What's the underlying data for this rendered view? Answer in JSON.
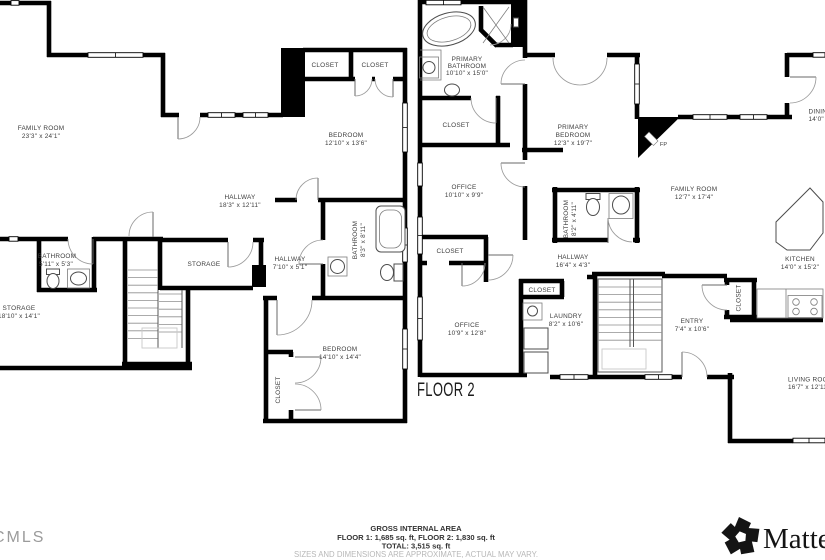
{
  "floor_label": "FLOOR 2",
  "area_summary": {
    "title": "GROSS INTERNAL AREA",
    "line1": "FLOOR 1: 1,685 sq. ft, FLOOR 2: 1,830 sq. ft",
    "line2": "TOTAL: 3,515 sq. ft",
    "disclaimer": "SIZES AND DIMENSIONS ARE APPROXIMATE, ACTUAL MAY VARY."
  },
  "branding": {
    "left_logo": "CMLS",
    "right_logo": "Matterport"
  },
  "colors": {
    "wall": "#000000",
    "label": "#3d3d3d",
    "muted": "#b8b8b8",
    "logo_gray": "#9b9b9b"
  },
  "rooms": [
    {
      "line1": "FAMILY ROOM",
      "dims": "23'3\" x 24'1\""
    },
    {
      "line1": "HALLWAY",
      "dims": "18'3\" x 12'11\""
    },
    {
      "line1": "BATHROOM",
      "dims": "5'11\" x 5'3\""
    },
    {
      "line1": "STORAGE",
      "dims": "18'10\" x 14'1\""
    },
    {
      "line1": "STORAGE"
    },
    {
      "line1": "CLOSET"
    },
    {
      "line1": "CLOSET"
    },
    {
      "line1": "BEDROOM",
      "dims": "12'10\" x 13'6\""
    },
    {
      "line1": "HALLWAY",
      "dims": "7'10\" x 5'1\""
    },
    {
      "line1": "BATHROOM",
      "dims": "8'3\" x 8'11\""
    },
    {
      "line1": "BEDROOM",
      "dims": "14'10\" x 14'4\""
    },
    {
      "line1": "CLOSET"
    },
    {
      "line1": "PRIMARY",
      "line2": "BATHROOM",
      "dims": "10'10\" x 15'0\""
    },
    {
      "line1": "CLOSET"
    },
    {
      "line1": "OFFICE",
      "dims": "10'10\" x 9'9\""
    },
    {
      "line1": "CLOSET"
    },
    {
      "line1": "OFFICE",
      "dims": "10'9\" x 12'8\""
    },
    {
      "line1": "CLOSET"
    },
    {
      "line1": "LAUNDRY",
      "dims": "8'2\" x 10'6\""
    },
    {
      "line1": "PRIMARY",
      "line2": "BEDROOM",
      "dims": "12'3\" x 19'7\""
    },
    {
      "line1": "BATHROOM",
      "dims": "8'2\" x 4'11\""
    },
    {
      "line1": "HALLWAY",
      "dims": "16'4\" x 4'3\""
    },
    {
      "line1": "FAMILY ROOM",
      "dims": "12'7\" x 17'4\""
    },
    {
      "line1": "FP"
    },
    {
      "line1": "ENTRY",
      "dims": "7'4\" x 10'6\""
    },
    {
      "line1": "CLOSET"
    },
    {
      "line1": "KITCHEN",
      "dims": "14'0\" x 15'2\""
    },
    {
      "line1": "DINING",
      "dims": "14'0\""
    },
    {
      "line1": "LIVING ROOM",
      "dims": "16'7\" x 12'11\""
    }
  ]
}
